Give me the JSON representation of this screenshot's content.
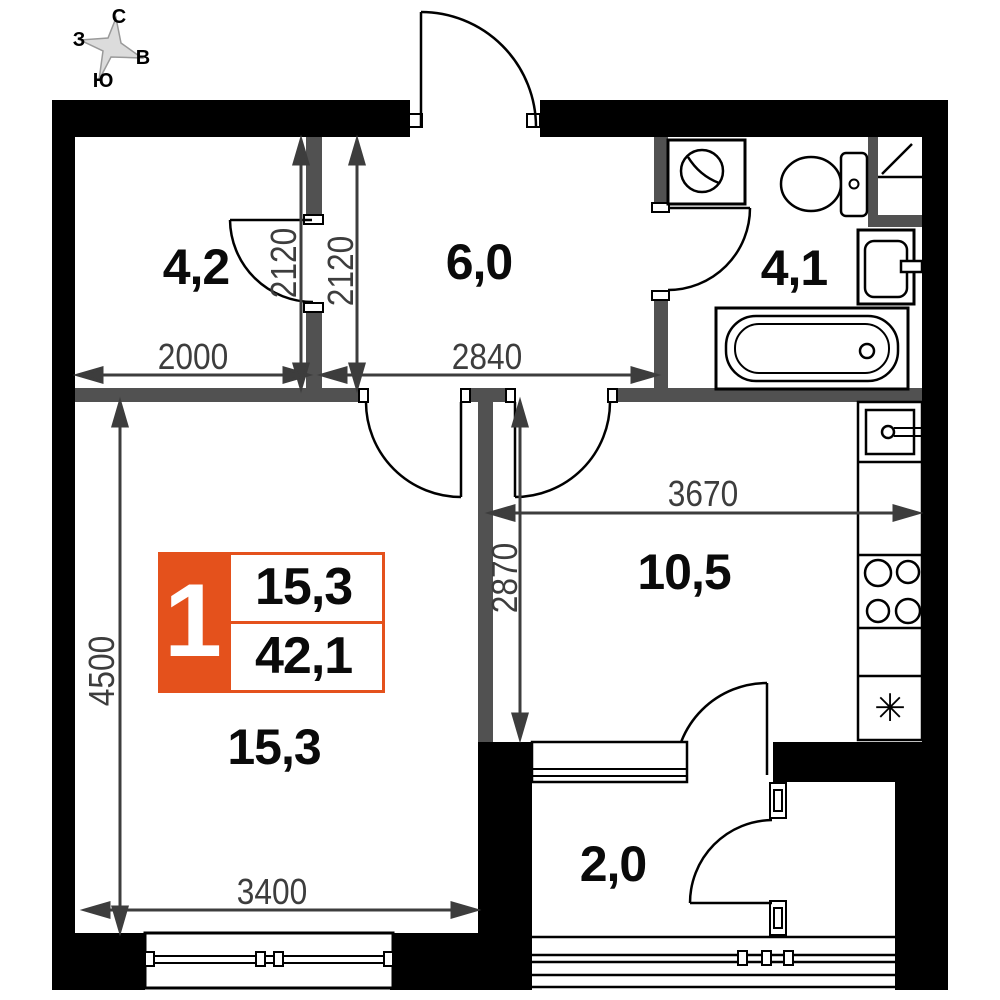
{
  "compass": {
    "north": "С",
    "south": "Ю",
    "west": "З",
    "east": "В"
  },
  "unit_badge": {
    "number": "1",
    "living_area": "15,3",
    "total_area": "42,1"
  },
  "rooms": [
    {
      "id": "closet",
      "area": "4,2"
    },
    {
      "id": "hallway",
      "area": "6,0"
    },
    {
      "id": "bathroom",
      "area": "4,1"
    },
    {
      "id": "kitchen",
      "area": "10,5"
    },
    {
      "id": "living-room",
      "area": "15,3"
    },
    {
      "id": "balcony",
      "area": "2,0"
    }
  ],
  "dimensions_mm": {
    "closet_width": "2000",
    "hallway_width": "2840",
    "closet_depth": "2120",
    "hallway_depth": "2120",
    "kitchen_width": "3670",
    "kitchen_depth": "2870",
    "living_depth": "4500",
    "living_width": "3400"
  },
  "symbols": {
    "fridge": "✳"
  },
  "colors": {
    "accent_orange": "#E4511C",
    "wall_black": "#000000",
    "partition_gray": "#515151",
    "dimension_gray": "#3D3D3D"
  }
}
